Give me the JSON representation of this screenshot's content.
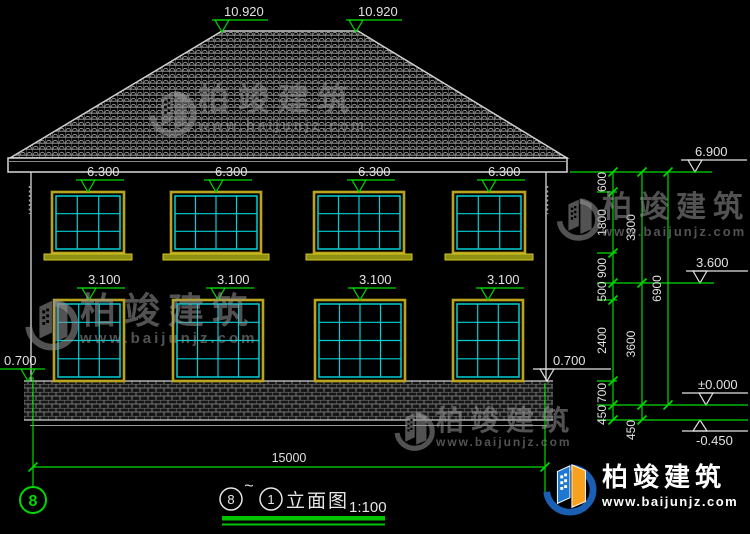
{
  "meta": {
    "drawing_type": "building front elevation CAD drawing",
    "colors": {
      "accent_green": "#00d900",
      "window_cyan": "#00cfd4",
      "frame_yellow": "#b9a41e",
      "line_white": "#e2e2e2",
      "background": "#000000"
    }
  },
  "labels": {
    "ridge": [
      "10.920",
      "10.920"
    ],
    "upper": [
      "6.300",
      "6.300",
      "6.300",
      "6.300"
    ],
    "lower": [
      "3.100",
      "3.100",
      "3.100",
      "3.100"
    ],
    "plinth_left": "0.700",
    "plinth_right": "0.700",
    "level_eave": "6.900",
    "level_floor2": "3.600",
    "level_zero": "±0.000",
    "level_minus": "-0.450"
  },
  "dims": {
    "col1": [
      "600",
      "1800",
      "900",
      "500",
      "2400",
      "700",
      "450"
    ],
    "col2": [
      "3300",
      "3600",
      "450"
    ],
    "col3": [
      "6900"
    ],
    "total": "15000"
  },
  "grid": {
    "left_bubble": "8"
  },
  "title": {
    "from": "8",
    "tilde": "~",
    "to": "1",
    "name": "立面图",
    "scale": "1:100"
  },
  "brand": {
    "name": "柏竣建筑",
    "url": "www.baijunjz.com"
  }
}
